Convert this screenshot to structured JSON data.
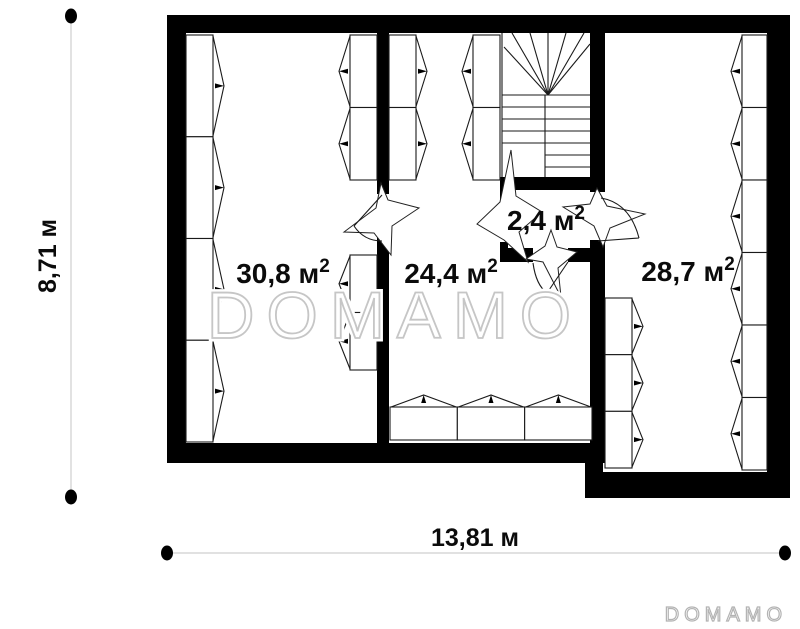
{
  "plan": {
    "rooms": [
      {
        "name": "room-30-8",
        "area": "30,8 м",
        "sup": "2"
      },
      {
        "name": "room-24-4",
        "area": "24,4 м",
        "sup": "2"
      },
      {
        "name": "room-2-4",
        "area": "2,4 м",
        "sup": "2"
      },
      {
        "name": "room-28-7",
        "area": "28,7 м",
        "sup": "2"
      }
    ],
    "dimensions": {
      "vertical": "8,71 м",
      "horizontal": "13,81 м"
    },
    "watermark": "DOMAMO",
    "logo": "DOMAMO",
    "colors": {
      "wall": "#000000",
      "dimension_line": "#cfcfcf",
      "watermark_outline": "#c6c6c6"
    }
  }
}
